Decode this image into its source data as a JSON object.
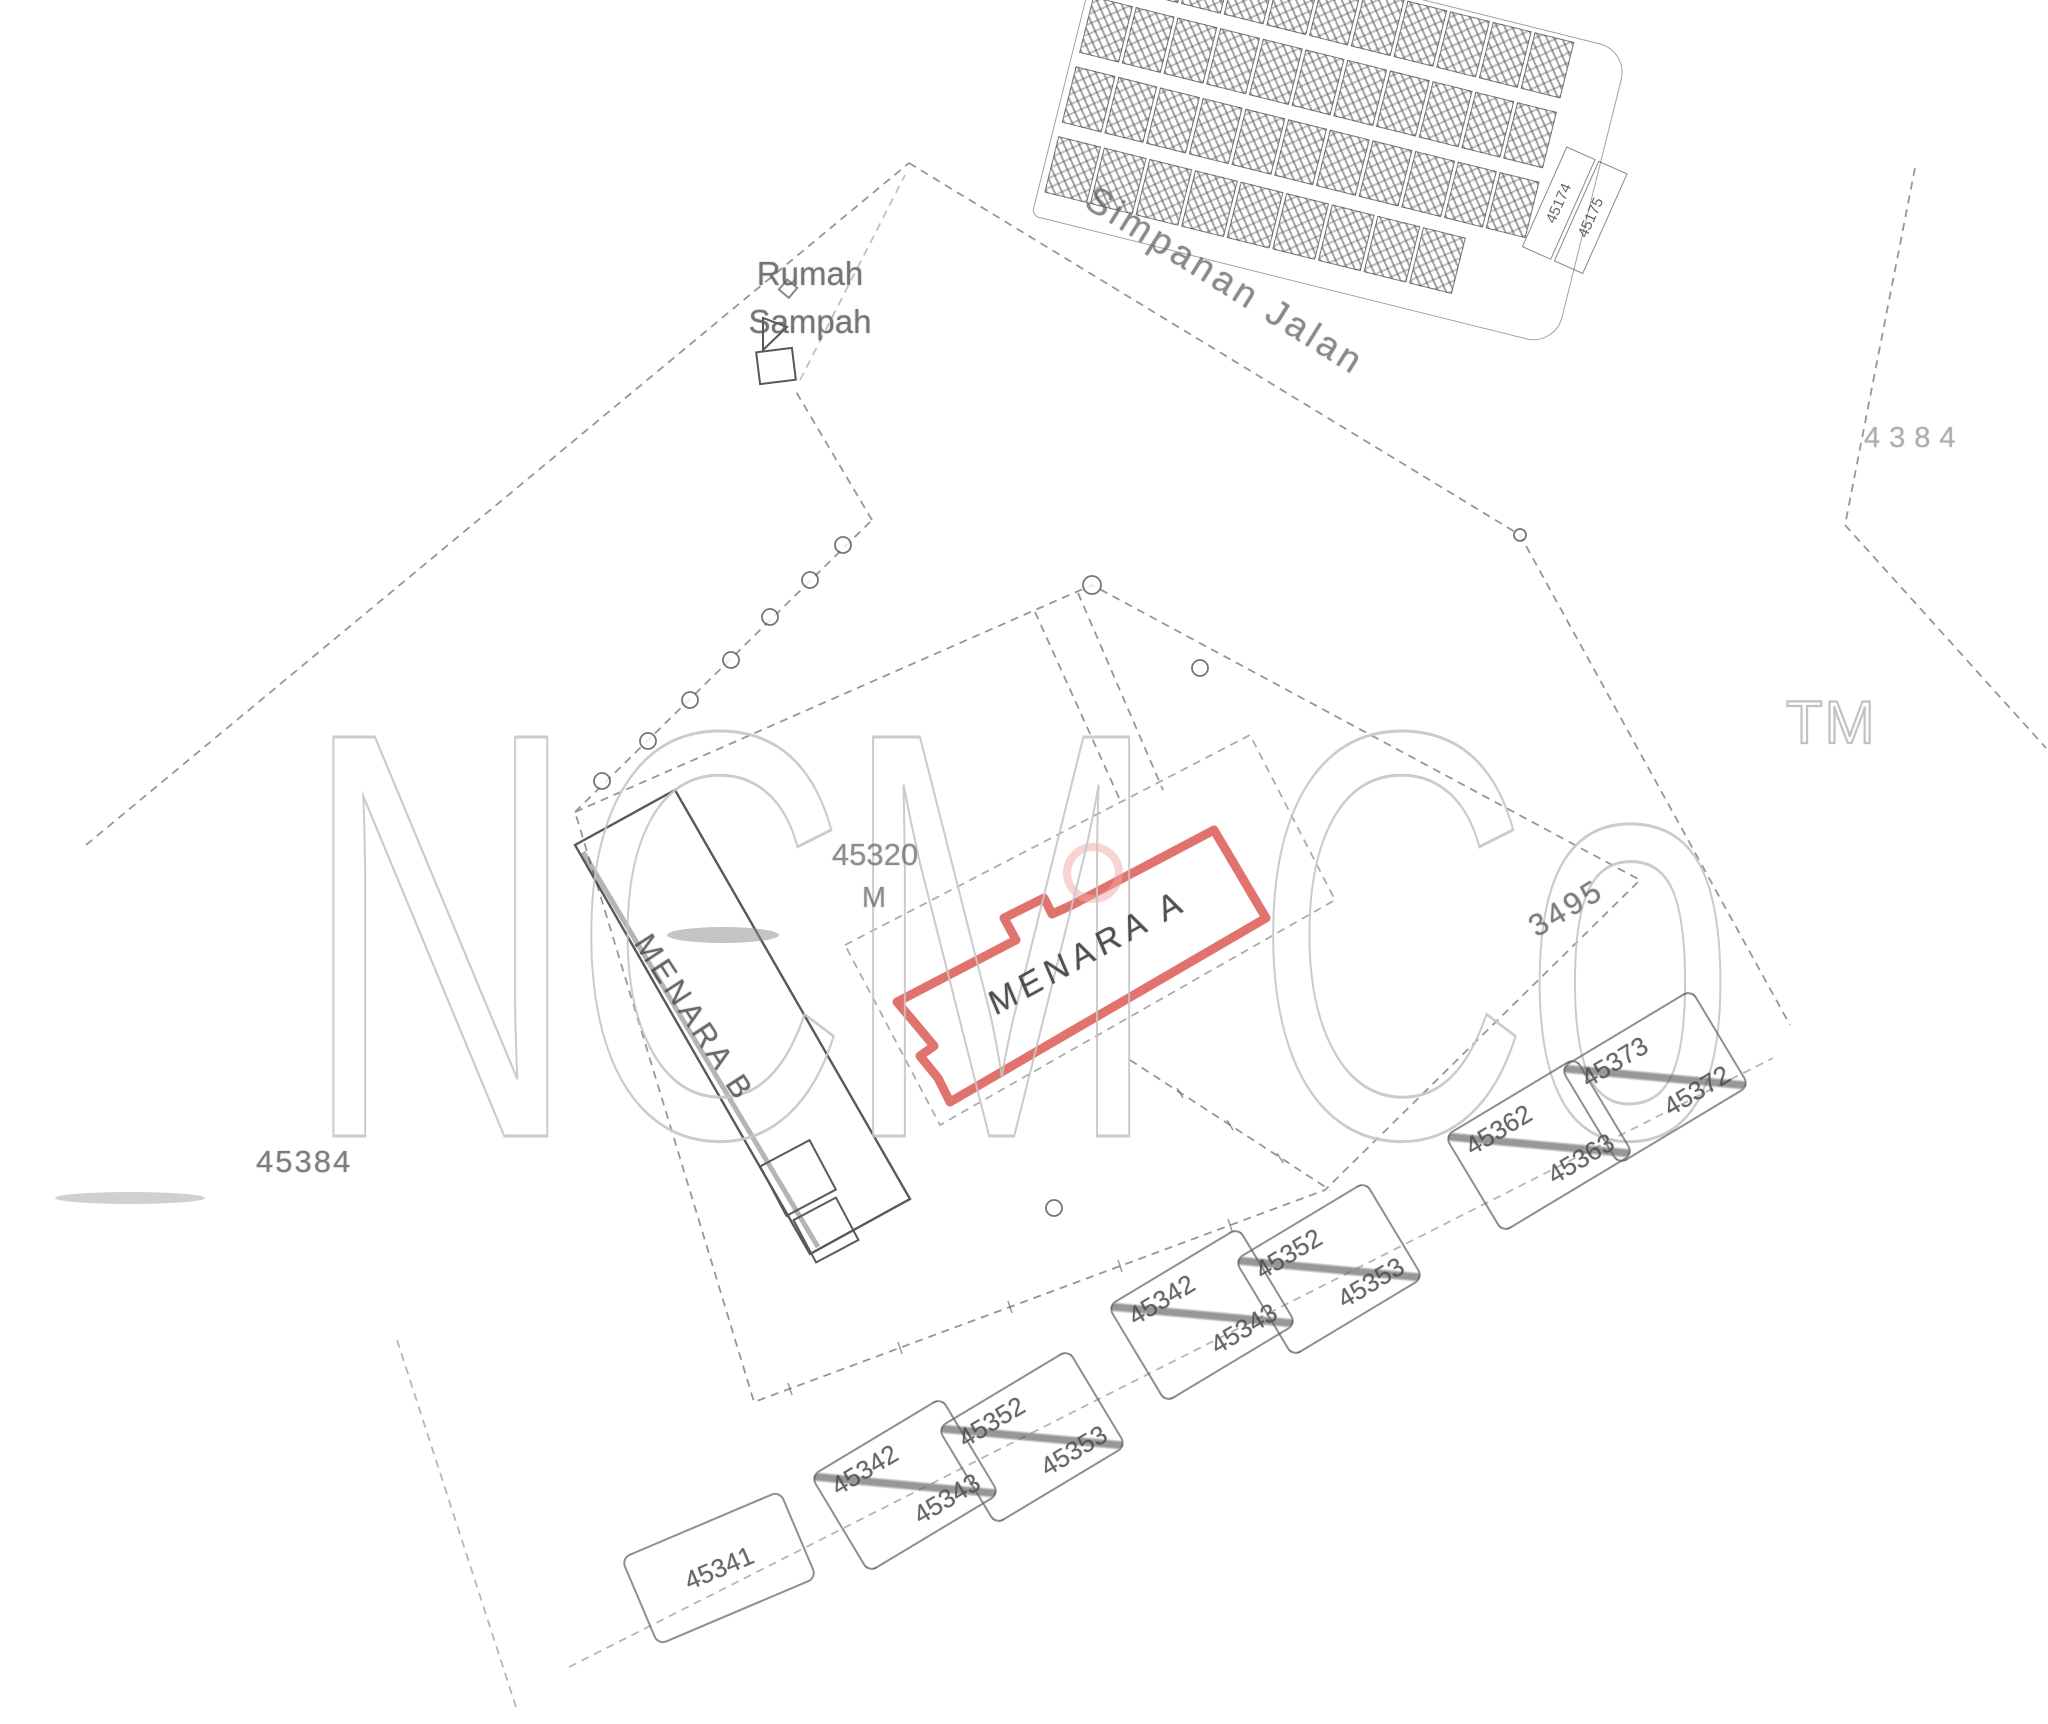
{
  "watermark": {
    "text": "NCM Co",
    "tm": "TM",
    "color": "#c6c6c6"
  },
  "labels": {
    "rumah_sampah_line1": "Rumah",
    "rumah_sampah_line2": "Sampah",
    "simpanan_jalan": "Simpanan Jalan",
    "lot_45320_number": "45320",
    "lot_45320_unit": "M",
    "menara_a": "MENARA A",
    "menara_b": "MENARA B",
    "lot_3495": "3495",
    "lot_45384": "45384",
    "lot_4384": "4384"
  },
  "terrace": {
    "end_numbers": [
      "45174",
      "45175"
    ]
  },
  "parcel_boxes": [
    {
      "id": "upper-left",
      "top": "45362",
      "bottom": "45363"
    },
    {
      "id": "upper-right",
      "top": "45373",
      "bottom": "45372"
    },
    {
      "id": "middle-left",
      "top": "45342",
      "bottom": "45343"
    },
    {
      "id": "middle-right",
      "top": "45352",
      "bottom": "45353"
    },
    {
      "id": "lower-left",
      "top": "45342",
      "bottom": "45343"
    },
    {
      "id": "lower-right",
      "top": "45352",
      "bottom": "45353"
    },
    {
      "id": "single",
      "top": "45341",
      "bottom": ""
    }
  ],
  "colors": {
    "highlight_red": "#d9504b",
    "sketch_gray": "#5f5f5f",
    "watermark_gray": "#c6c6c6"
  }
}
